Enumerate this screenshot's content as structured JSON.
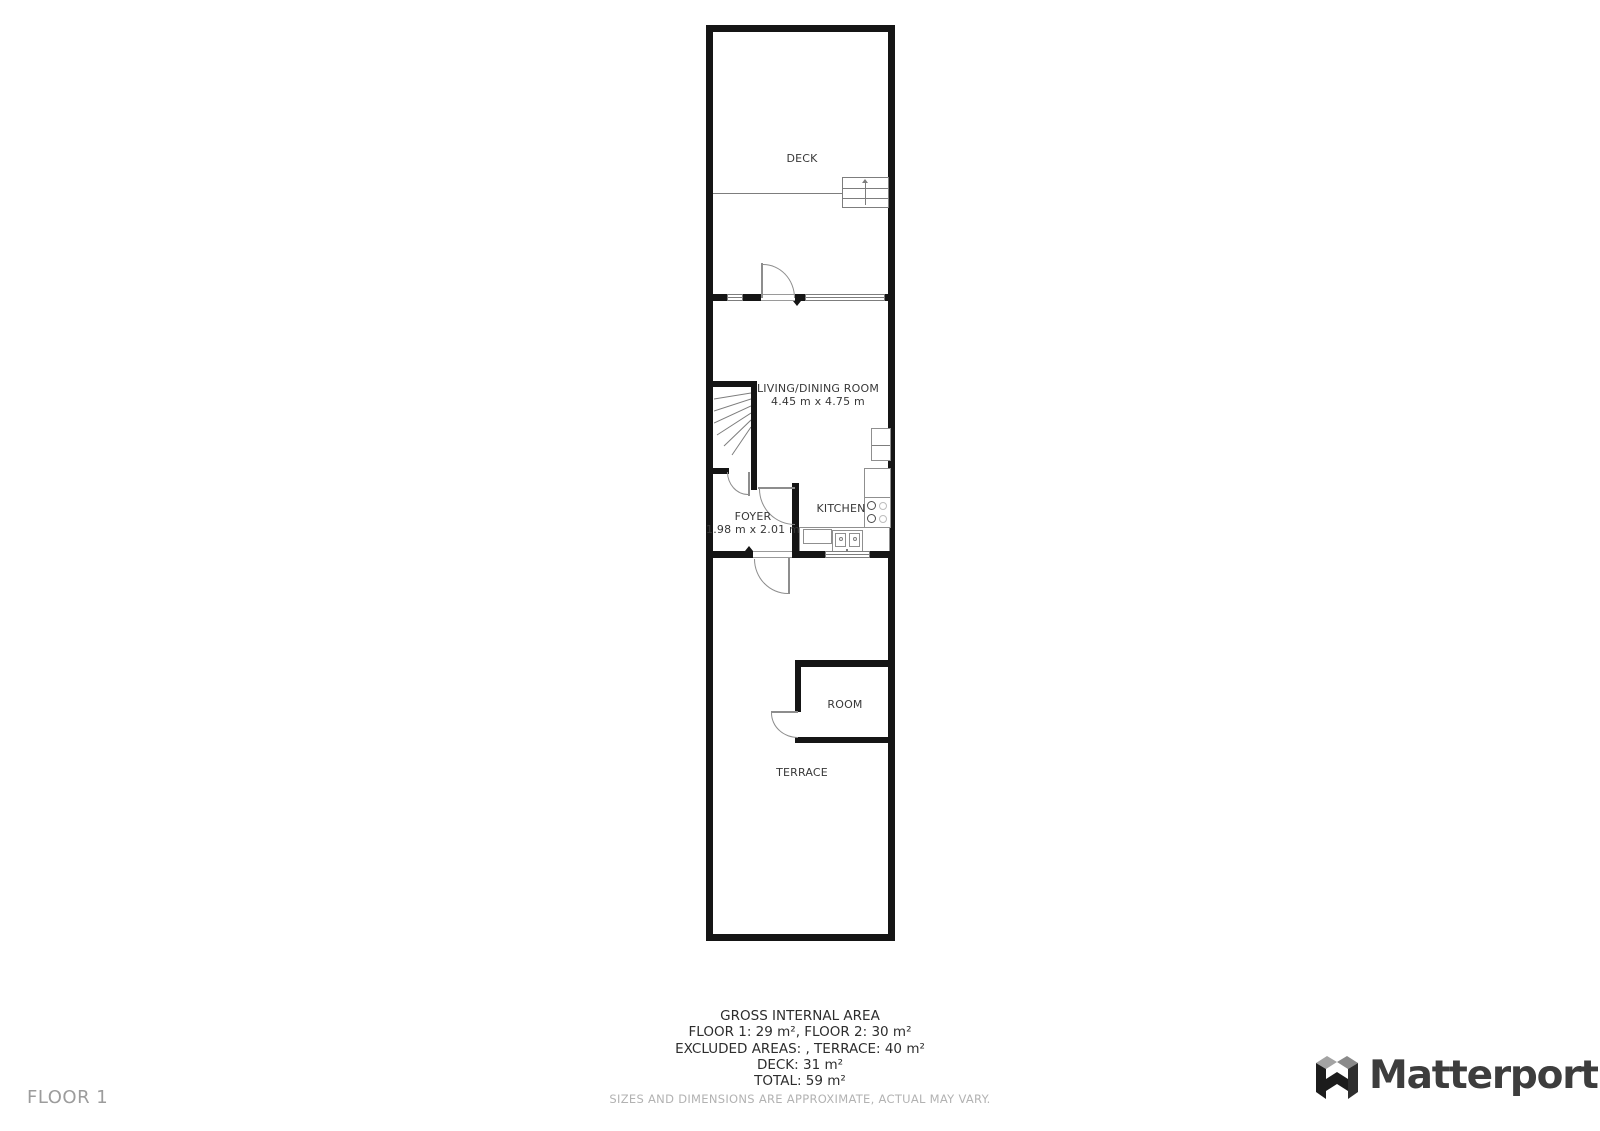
{
  "plan": {
    "rooms": {
      "deck": {
        "label": "DECK"
      },
      "living_dining": {
        "label": "LIVING/DINING ROOM",
        "dimensions": "4.45 m x 4.75 m"
      },
      "foyer": {
        "label": "FOYER",
        "dimensions": "1.98 m x 2.01 m"
      },
      "kitchen": {
        "label": "KITCHEN"
      },
      "room": {
        "label": "ROOM"
      },
      "terrace": {
        "label": "TERRACE"
      }
    }
  },
  "footer": {
    "title": "GROSS INTERNAL AREA",
    "lines": [
      "FLOOR 1: 29 m², FLOOR 2: 30 m²",
      "EXCLUDED AREAS: , TERRACE: 40 m²",
      "DECK: 31 m²",
      "TOTAL: 59 m²"
    ],
    "disclaimer": "SIZES AND DIMENSIONS ARE APPROXIMATE, ACTUAL MAY VARY."
  },
  "page": {
    "floor_label": "FLOOR 1"
  },
  "brand": {
    "name": "Matterport"
  },
  "colors": {
    "wall": "#151515",
    "fixture_line": "#7d7d7d",
    "label_text": "#383838",
    "muted_text": "#b2b2b2"
  }
}
